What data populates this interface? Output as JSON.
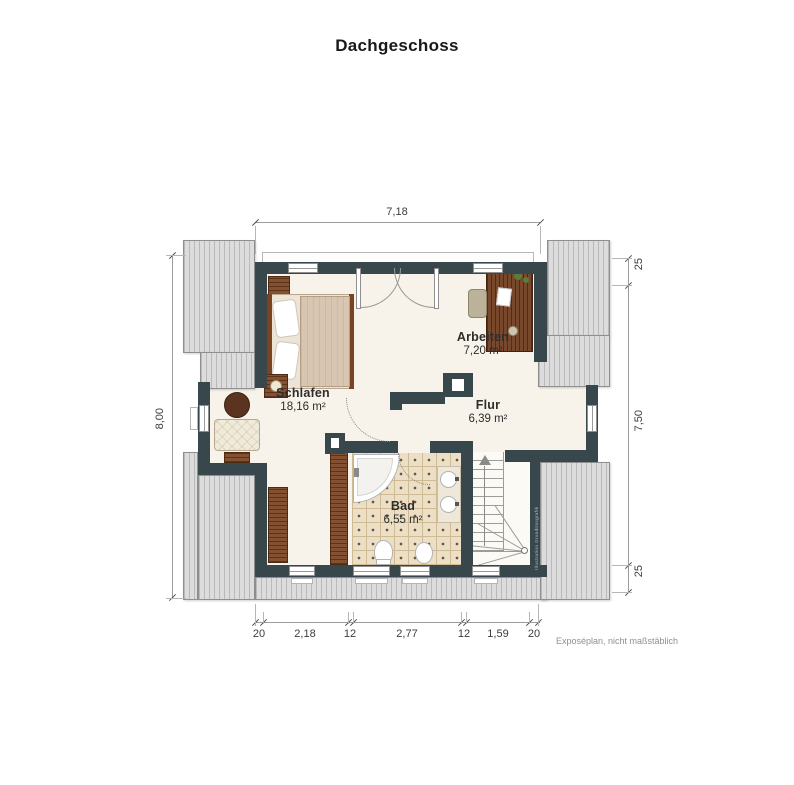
{
  "title": "Dachgeschoss",
  "rooms": [
    {
      "name": "Schlafen",
      "area": "18,16 m²"
    },
    {
      "name": "Arbeiten",
      "area": "7,20 m²"
    },
    {
      "name": "Flur",
      "area": "6,39 m²"
    },
    {
      "name": "Bad",
      "area": "6,55 m²"
    }
  ],
  "dimensions": {
    "top_width": "7,18",
    "left_height": "8,00",
    "right": [
      "25",
      "7,50",
      "25"
    ],
    "bottom": [
      "20",
      "2,18",
      "12",
      "2,77",
      "12",
      "1,59",
      "20"
    ]
  },
  "footnote": "Exposéplan, nicht maßstäblich",
  "watermark": "Illustration Grundrissgrafik",
  "colors": {
    "wall": "#38474c",
    "floor": "#f7f3ea",
    "roof_stripe_light": "#dcdcdc",
    "roof_stripe_dark": "#b9b9b9",
    "wood": "#7a4423",
    "tile": "#ecdfc7",
    "dimension_text": "#3c3c3c"
  }
}
